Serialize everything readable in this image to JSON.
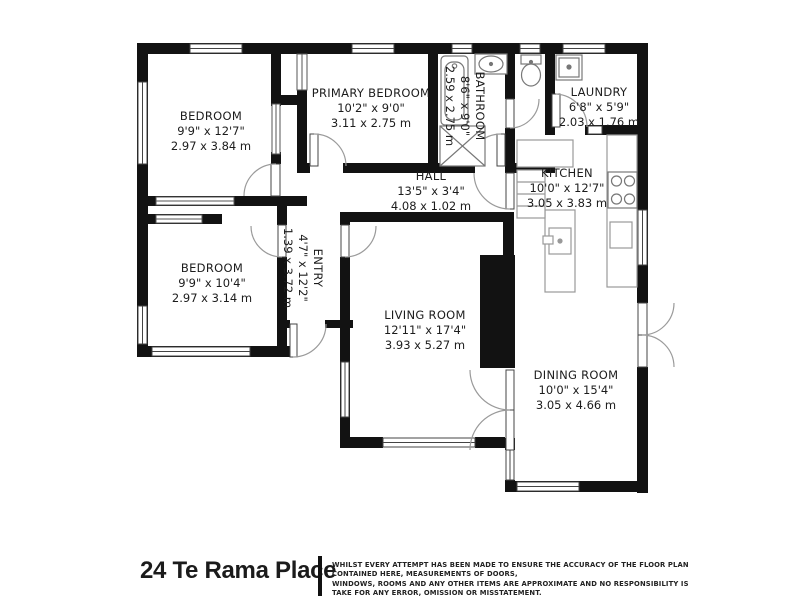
{
  "title": "24 Te Rama Place",
  "disclaimer": {
    "line1": "WHILST EVERY ATTEMPT HAS BEEN MADE TO ENSURE THE ACCURACY OF THE FLOOR PLAN CONTAINED HERE, MEASUREMENTS OF DOORS,",
    "line2": "WINDOWS, ROOMS AND ANY OTHER ITEMS ARE APPROXIMATE AND NO RESPONSIBILITY IS TAKE FOR ANY ERROR, OMISSION OR MISSTATEMENT.",
    "line3": "THIS PLAN IS FOR ILLUSTRATIVE PURPOSES ONLY AND SHOULD BE USED AS SUCH BY ANY PROSPECTIVE PURCHASER."
  },
  "colors": {
    "wall": "#121212",
    "background": "#ffffff",
    "label_text": "#1c1c1c",
    "fixture_outline": "#777777"
  },
  "rooms": [
    {
      "name": "BEDROOM",
      "imperial": "9'9\" x 12'7\"",
      "metric": "2.97 x 3.84 m"
    },
    {
      "name": "PRIMARY BEDROOM",
      "imperial": "10'2\" x 9'0\"",
      "metric": "3.11 x 2.75 m"
    },
    {
      "name": "BATHROOM",
      "imperial": "8'6\" x 9'0\"",
      "metric": "2.59 x 2.75 m"
    },
    {
      "name": "LAUNDRY",
      "imperial": "6'8\" x 5'9\"",
      "metric": "2.03 x 1.76 m"
    },
    {
      "name": "HALL",
      "imperial": "13'5\" x 3'4\"",
      "metric": "4.08 x 1.02 m"
    },
    {
      "name": "ENTRY",
      "imperial": "4'7\" x 12'2\"",
      "metric": "1.39 x 3.72 m"
    },
    {
      "name": "KITCHEN",
      "imperial": "10'0\" x 12'7\"",
      "metric": "3.05 x 3.83 m"
    },
    {
      "name": "BEDROOM",
      "imperial": "9'9\" x 10'4\"",
      "metric": "2.97 x 3.14 m"
    },
    {
      "name": "LIVING ROOM",
      "imperial": "12'11\" x 17'4\"",
      "metric": "3.93 x 5.27 m"
    },
    {
      "name": "DINING ROOM",
      "imperial": "10'0\" x 15'4\"",
      "metric": "3.05 x 4.66 m"
    }
  ]
}
